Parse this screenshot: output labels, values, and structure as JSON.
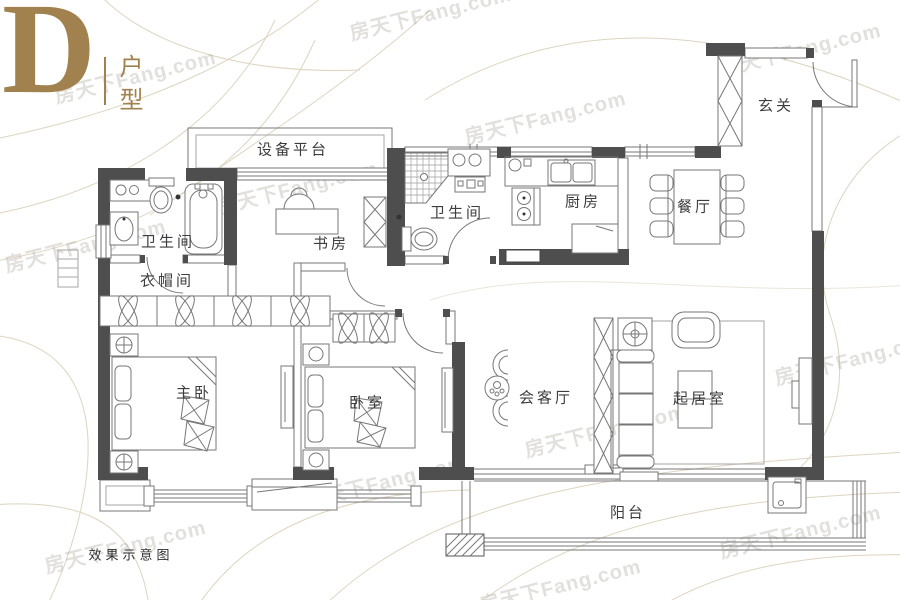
{
  "title": {
    "letter": "D",
    "unit_type": "户型"
  },
  "watermark": {
    "text": "房天下Fang.com"
  },
  "rooms": {
    "equipment_platform": {
      "label": "设备平台"
    },
    "bathroom_main": {
      "label": "卫生间"
    },
    "cloakroom": {
      "label": "衣帽间"
    },
    "study": {
      "label": "书房"
    },
    "bathroom_second": {
      "label": "卫生间"
    },
    "kitchen": {
      "label": "厨房"
    },
    "dining_room": {
      "label": "餐厅"
    },
    "entry": {
      "label": "玄关"
    },
    "master_bedroom": {
      "label": "主卧"
    },
    "second_bedroom": {
      "label": "卧室"
    },
    "family_room": {
      "label": "会客厅"
    },
    "living_room": {
      "label": "起居室"
    },
    "balcony": {
      "label": "阳台"
    }
  },
  "footnote": {
    "text": "效果示意图"
  },
  "colors": {
    "accent_gold": "#a1824e",
    "wall_dark": "#4e4e4e",
    "line": "#777777",
    "contour": "#ded4c0",
    "watermark": "#a8a298"
  }
}
